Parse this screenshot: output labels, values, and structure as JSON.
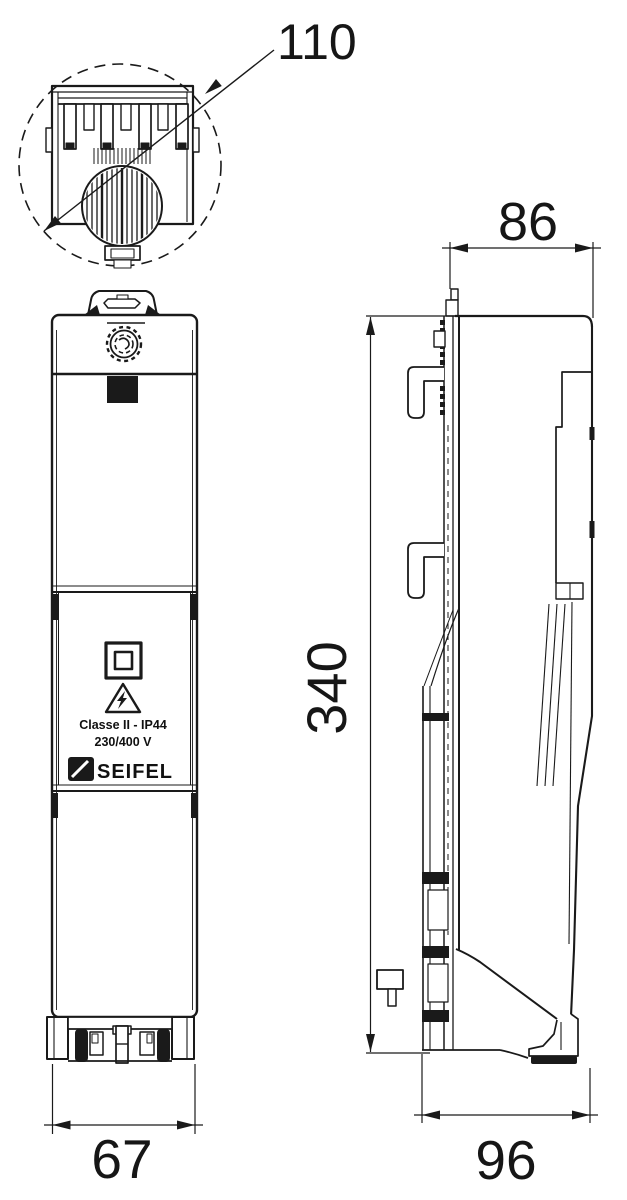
{
  "meta": {
    "type": "technical-dimensional-drawing",
    "background_color": "#ffffff",
    "line_color": "#1a1a1a"
  },
  "dimensions": {
    "detail_width": "110",
    "front_width": "67",
    "depth_top": "86",
    "height": "340",
    "depth_bottom": "96"
  },
  "label_plate": {
    "class_rating": "Classe II - IP44",
    "voltage": "230/400 V",
    "brand": "SEIFEL"
  }
}
